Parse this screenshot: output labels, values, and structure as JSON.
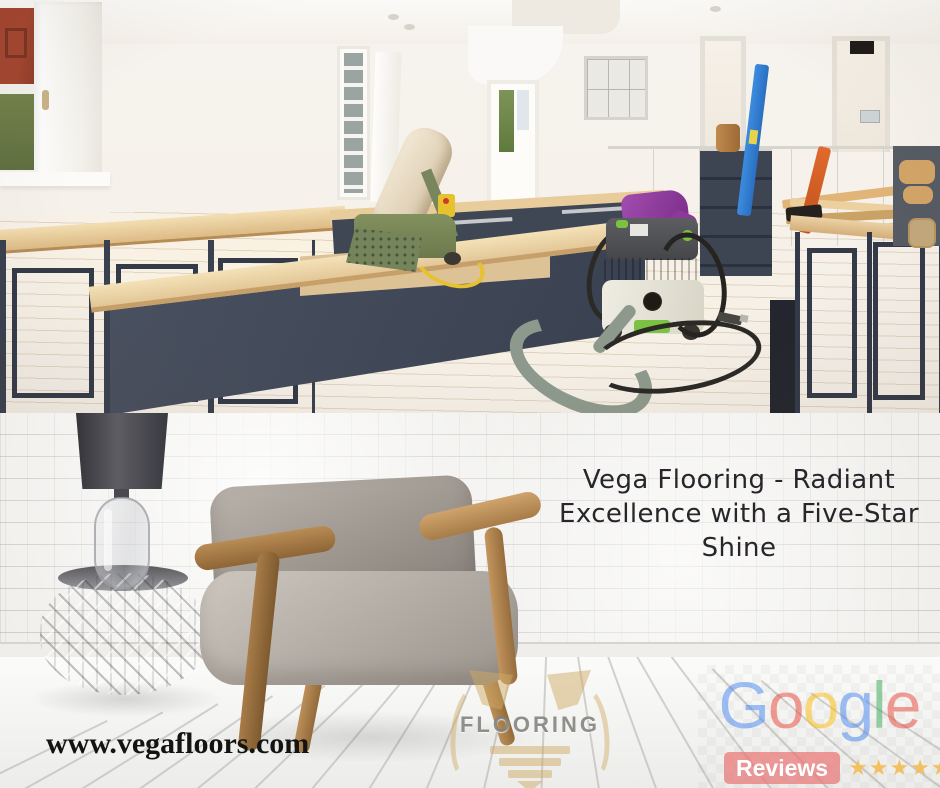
{
  "headline": {
    "lines": [
      "Vega Flooring - Radiant",
      "Excellence with a Five-Star",
      "Shine"
    ],
    "text_color": "#26262B"
  },
  "website": {
    "url": "www.vegafloors.com",
    "text_color": "#131313"
  },
  "google_reviews": {
    "word": "Google",
    "letters": [
      {
        "char": "G",
        "color": "#4285F4"
      },
      {
        "char": "o",
        "color": "#EA4335"
      },
      {
        "char": "o",
        "color": "#FBBC05"
      },
      {
        "char": "g",
        "color": "#4285F4"
      },
      {
        "char": "l",
        "color": "#34A853"
      },
      {
        "char": "e",
        "color": "#EA4335"
      }
    ],
    "reviews_label": "Reviews",
    "reviews_badge_color": "#E57373",
    "rating_stars": 5,
    "stars_icon": "★★★★★",
    "star_color": "#F2C05A"
  },
  "watermark_logo": {
    "label": "FLOORING",
    "mark": "v-flooring-mark",
    "accent_color": "#D0AA64",
    "label_color": "#767673"
  }
}
